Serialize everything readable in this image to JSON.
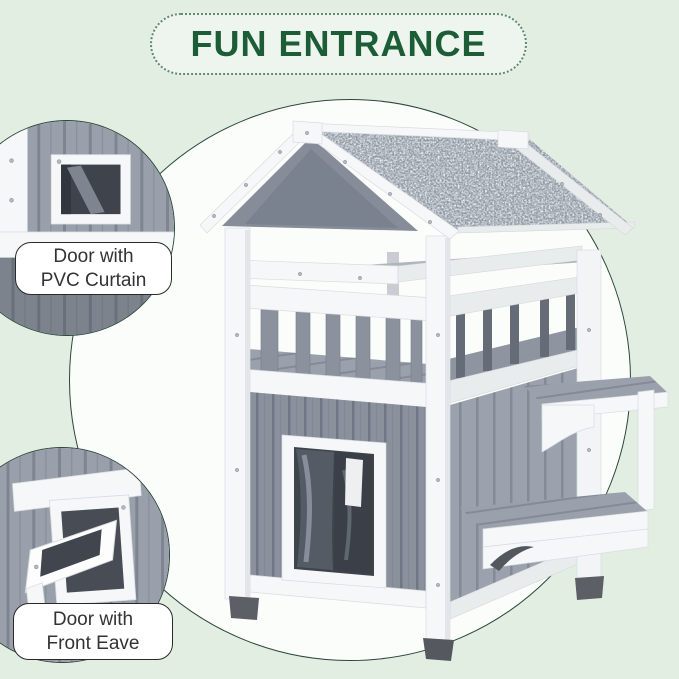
{
  "banner": {
    "title": "FUN ENTRANCE"
  },
  "callouts": {
    "pvc_curtain": {
      "line1": "Door with",
      "line2": "PVC Curtain"
    },
    "front_eave": {
      "line1": "Door with",
      "line2": "Front Eave"
    }
  },
  "illustration": {
    "alt": "Two-story gray and white wooden cat house with speckled asphalt gable roof, open balcony with railing, lower door with PVC curtain, and two side step platforms"
  },
  "colors": {
    "page_bg": "#e3eee3",
    "circle_bg": "#fbfdfb",
    "outline": "#2b473a",
    "banner_bg": "#eef5ee",
    "banner_text": "#1c5c36",
    "banner_dots": "#5f8a70",
    "label_bg": "#ffffff",
    "label_border": "#2a2a2a",
    "label_text": "#333333",
    "wood_white": "#f6f7f8",
    "siding_gray": "#8a919d",
    "siding_light": "#9ba2ad",
    "roof_gray": "#9098a2",
    "deck_gray": "#99a0ab",
    "curtain_dark": "#3e434c",
    "foot_dark": "#5c5f66"
  }
}
